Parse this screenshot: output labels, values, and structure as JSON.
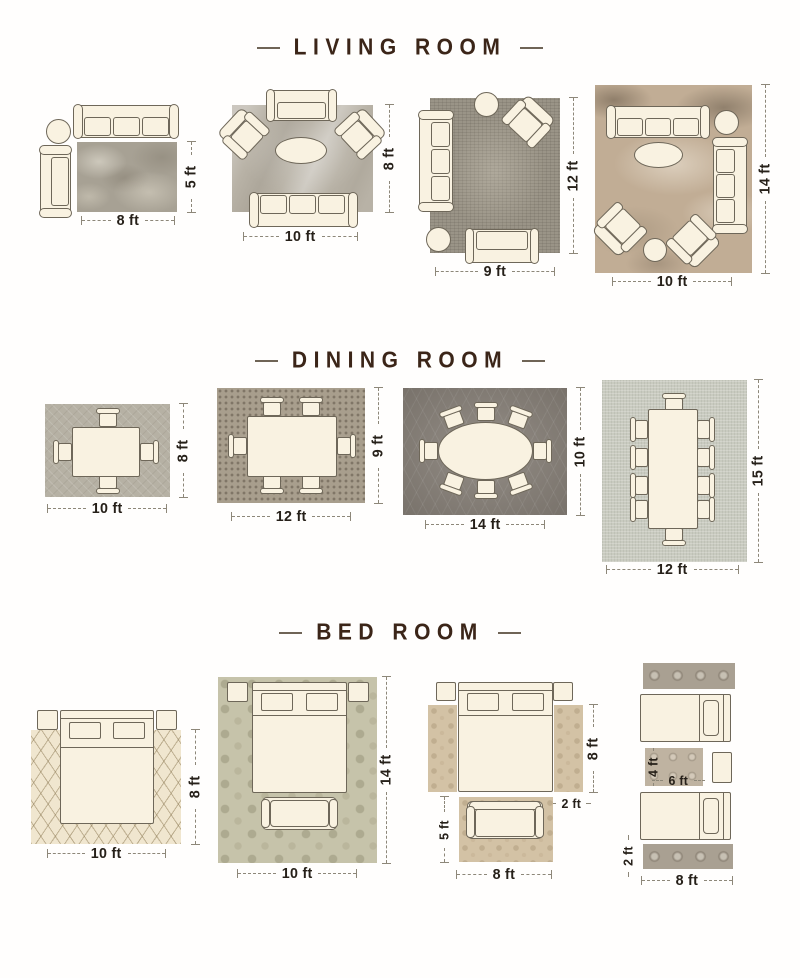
{
  "sections": {
    "living": {
      "title": "LIVING ROOM",
      "layouts": [
        {
          "width": "8 ft",
          "height": "5 ft"
        },
        {
          "width": "10 ft",
          "height": "8 ft"
        },
        {
          "width": "9 ft",
          "height": "12 ft"
        },
        {
          "width": "10 ft",
          "height": "14 ft"
        }
      ]
    },
    "dining": {
      "title": "DINING ROOM",
      "layouts": [
        {
          "width": "10 ft",
          "height": "8 ft"
        },
        {
          "width": "12 ft",
          "height": "9 ft"
        },
        {
          "width": "14 ft",
          "height": "10 ft"
        },
        {
          "width": "12 ft",
          "height": "15 ft"
        }
      ]
    },
    "bed": {
      "title": "BED ROOM",
      "layouts": [
        {
          "width": "10 ft",
          "height": "8 ft"
        },
        {
          "width": "10 ft",
          "height": "14 ft"
        },
        {
          "width": "8 ft",
          "bed_length": "8 ft",
          "runner_width": "2 ft",
          "sofa_rug_length": "5 ft"
        },
        {
          "width": "8 ft",
          "runner_width": "2 ft",
          "accent_rug_width": "6 ft",
          "accent_rug_length": "4 ft"
        }
      ]
    }
  },
  "colors": {
    "title_text": "#3b2518",
    "dimension_text": "#262019",
    "dimension_line": "#8d8779",
    "furniture_fill": "#f9f2e1",
    "furniture_outline": "#6e6759"
  }
}
